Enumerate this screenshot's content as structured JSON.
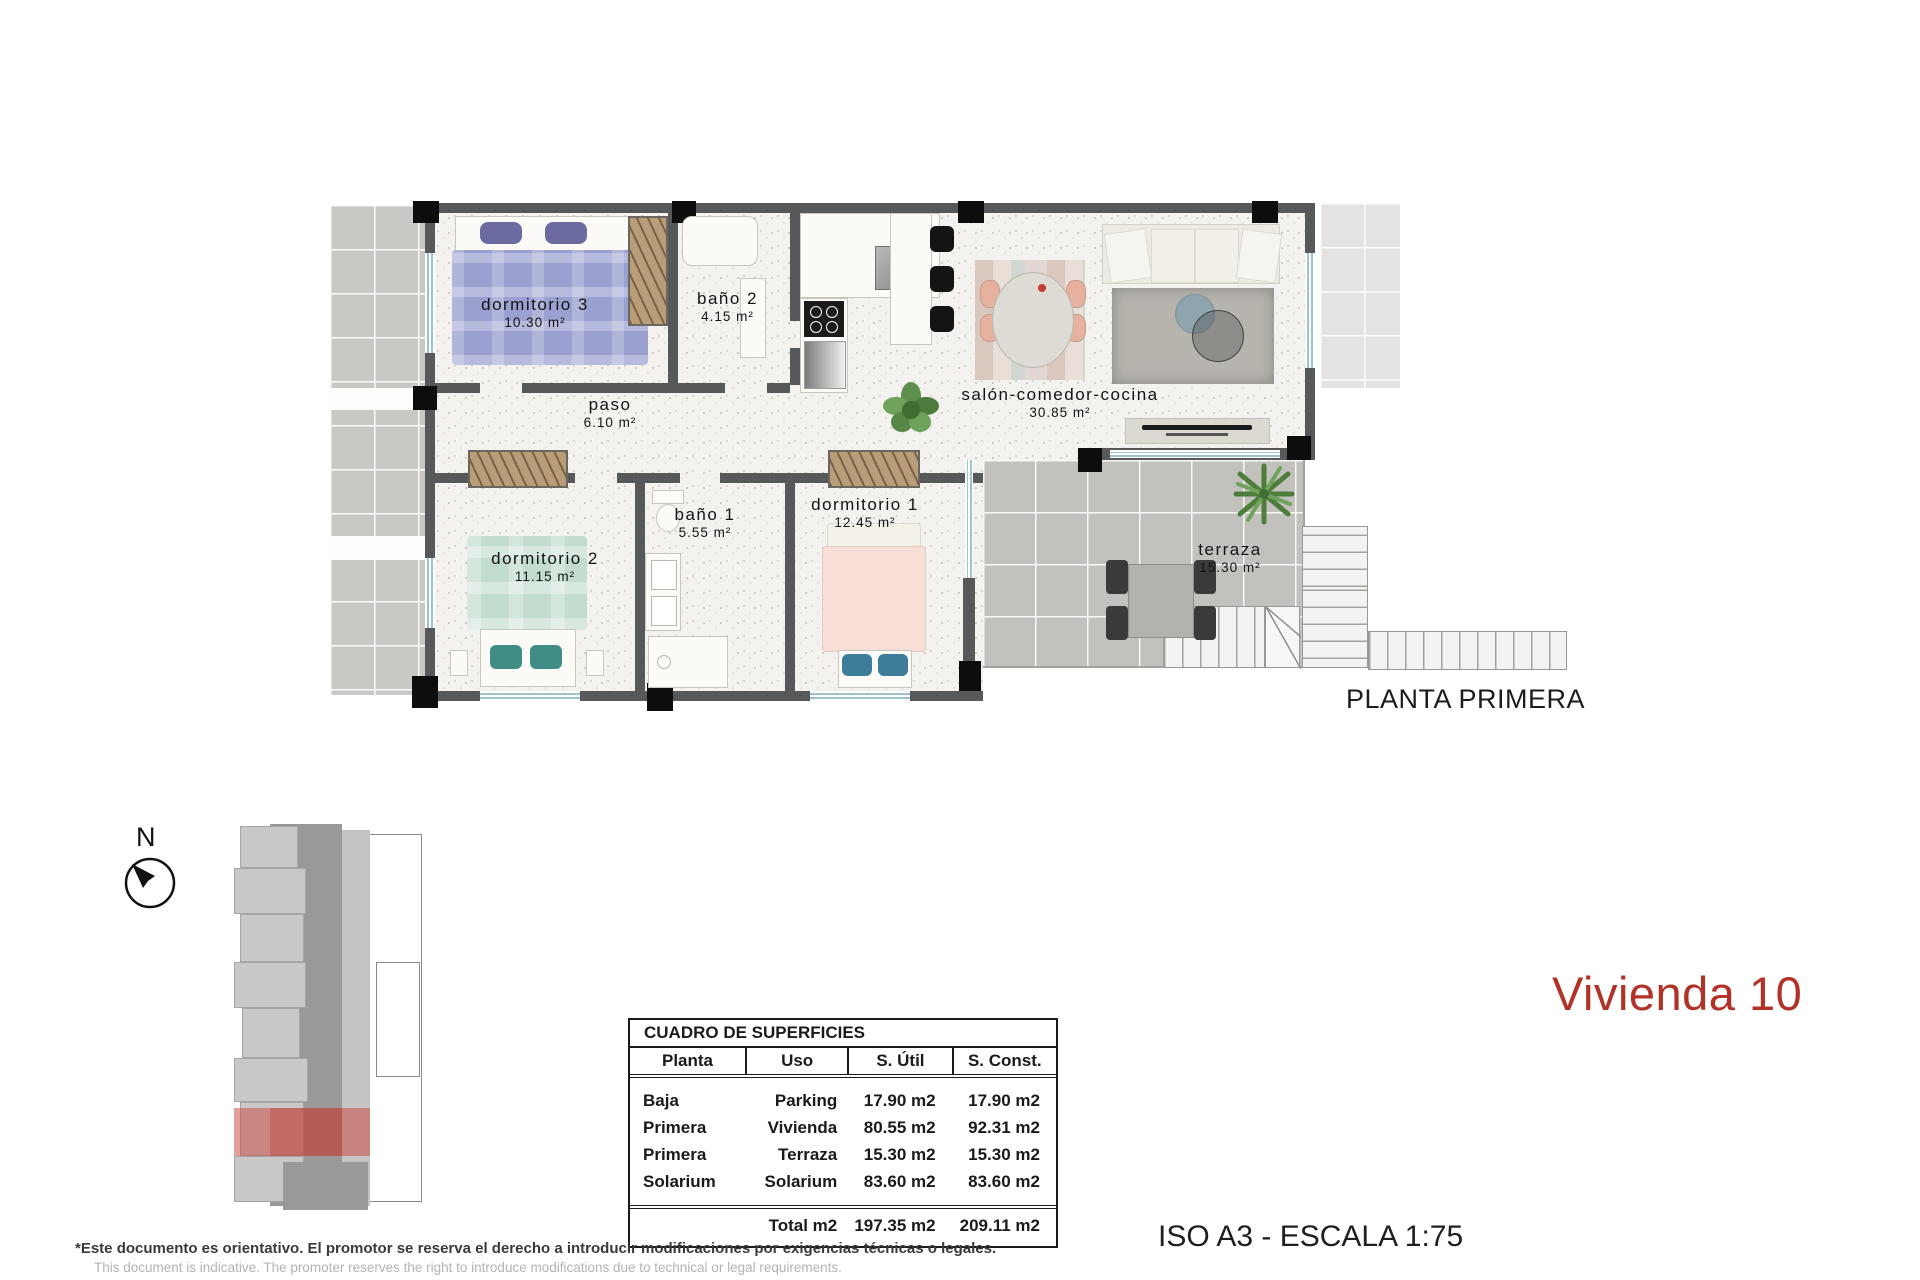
{
  "document": {
    "plan_title": "PLANTA PRIMERA",
    "unit_title": "Vivienda 10",
    "unit_title_color": "#b23228",
    "scale_note": "ISO A3 - ESCALA 1:75",
    "disclaimer_es": "*Este documento es orientativo. El promotor se reserva el derecho a introducir modificaciones por exigencias técnicas o legales.",
    "disclaimer_en": "This document is indicative. The promoter reserves the right to introduce modifications due to technical or legal requirements."
  },
  "compass": {
    "label": "N"
  },
  "plan": {
    "rooms": [
      {
        "label": "dormitorio 3",
        "area": "10.30 m²"
      },
      {
        "label": "baño 2",
        "area": "4.15 m²"
      },
      {
        "label": "paso",
        "area": "6.10 m²"
      },
      {
        "label": "salón-comedor-cocina",
        "area": "30.85 m²"
      },
      {
        "label": "dormitorio 2",
        "area": "11.15 m²"
      },
      {
        "label": "baño 1",
        "area": "5.55 m²"
      },
      {
        "label": "dormitorio 1",
        "area": "12.45 m²"
      },
      {
        "label": "terraza",
        "area": "15.30 m²"
      }
    ]
  },
  "surfaces_table": {
    "title": "CUADRO DE SUPERFICIES",
    "columns": [
      "Planta",
      "Uso",
      "S. Útil",
      "S. Const."
    ],
    "rows": [
      {
        "planta": "Baja",
        "uso": "Parking",
        "util": "17.90 m2",
        "const": "17.90 m2"
      },
      {
        "planta": "Primera",
        "uso": "Vivienda",
        "util": "80.55 m2",
        "const": "92.31 m2"
      },
      {
        "planta": "Primera",
        "uso": "Terraza",
        "util": "15.30 m2",
        "const": "15.30 m2"
      },
      {
        "planta": "Solarium",
        "uso": "Solarium",
        "util": "83.60 m2",
        "const": "83.60 m2"
      }
    ],
    "total": {
      "label": "Total m2",
      "util": "197.35 m2",
      "const": "209.11 m2"
    }
  }
}
